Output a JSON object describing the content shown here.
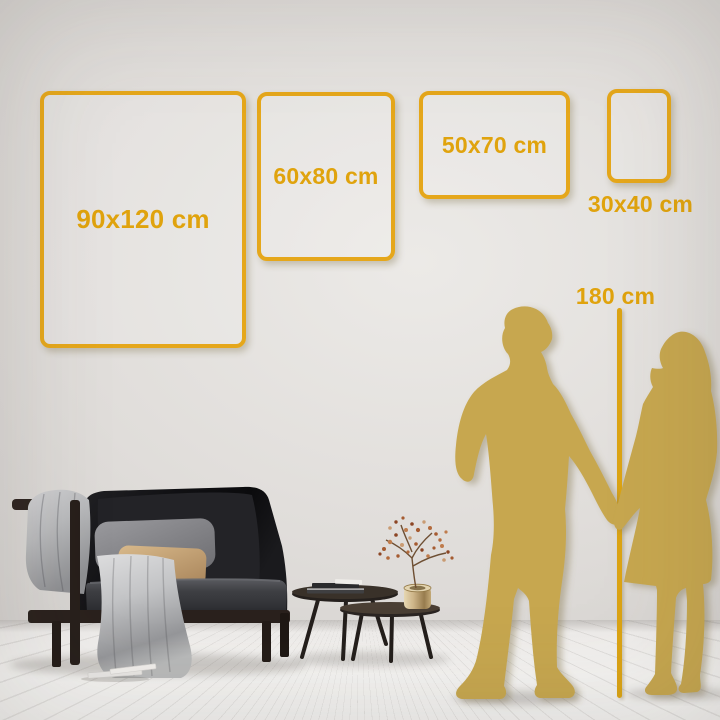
{
  "sizes": {
    "frames": [
      {
        "label": "90x120 cm"
      },
      {
        "label": "60x80 cm"
      },
      {
        "label": "50x70 cm"
      },
      {
        "label": "30x40 cm"
      }
    ],
    "height_reference": {
      "label": "180 cm"
    }
  },
  "colors": {
    "frame_gold": "#E5A71B",
    "label_gold": "#E0A30D",
    "ruler_gold": "#DCA414",
    "silhouette_gold": "#C7A74F",
    "wall": "#DDDAD7",
    "floor": "#F2F1EF"
  }
}
